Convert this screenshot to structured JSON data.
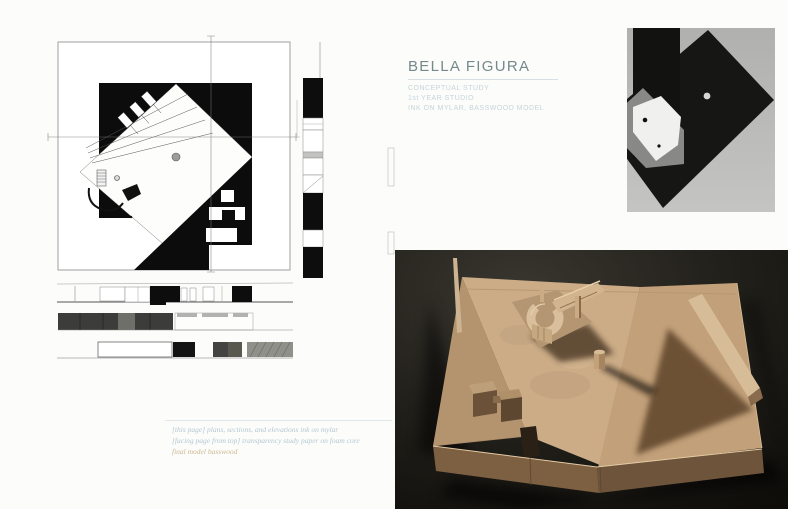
{
  "page": {
    "background": "#fcfcfb"
  },
  "title_block": {
    "title": "BELLA FIGURA",
    "subtitle_lines": [
      "CONCEPTUAL STUDY",
      "1st YEAR STUDIO",
      "INK ON MYLAR, BASSWOOD MODEL"
    ],
    "colors": {
      "title": "#75898b",
      "subtitle": "#c6d5da",
      "rule": "#d6e0e4"
    }
  },
  "caption_block": {
    "lines": [
      {
        "text": "[this page] plans, sections, and elevations ink on mylar",
        "color": "#b4c8d0"
      },
      {
        "text": "[facing page from top] transparency study paper on foam core",
        "color": "#b4c8d0"
      },
      {
        "text": "final model basswood",
        "color": "#ccb88f"
      }
    ]
  },
  "drawings": {
    "ink": "#0d0d0d",
    "paper": "#ffffff",
    "frame_line": "#8a8a8a"
  },
  "photos": {
    "transparency_study": {
      "background": "#b9b9b7",
      "diamond": "#161614",
      "white_sheet": "#f0f0ee"
    },
    "basswood_model": {
      "background": "#18160f",
      "wood_light": "#cbac87",
      "wood_shadow": "#63492f"
    }
  }
}
